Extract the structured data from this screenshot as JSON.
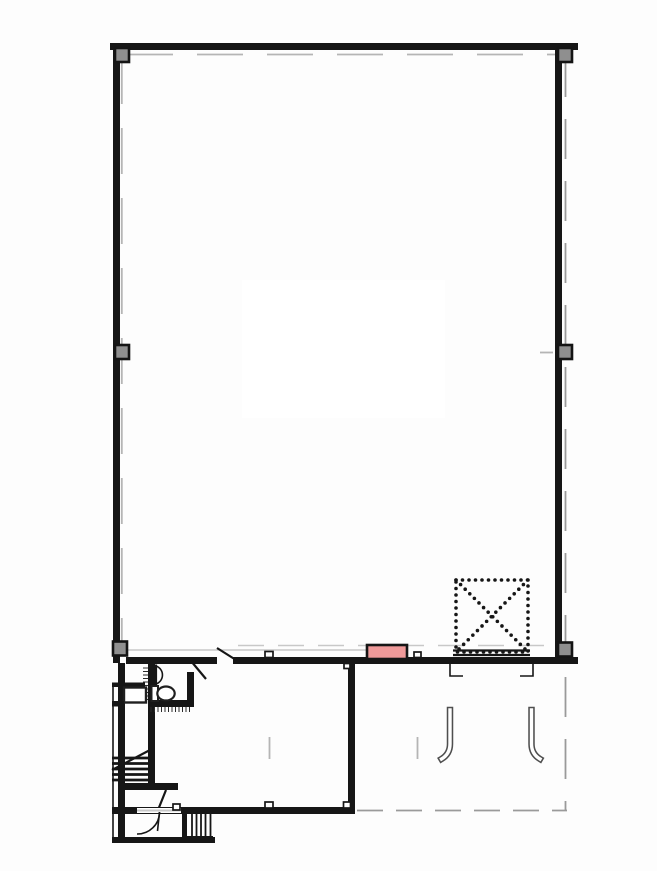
{
  "colors": {
    "wall": "#161616",
    "column_fill": "#8f8f8f",
    "column_border": "#141414",
    "accent_pink": "#f09a9a",
    "centerline": "#b5b5b5",
    "light_line": "#c8c8c8",
    "canopy_line": "#9a9a9a",
    "background": "#fdfdfd",
    "fixture_line": "#1f1f1f",
    "hook_line": "#4f4f4f"
  },
  "plan": {
    "features": [
      "main-hall-perimeter-walls",
      "column-markers",
      "dashed-roof-opening-with-x",
      "pink-door-marker",
      "restroom-with-toilet-and-sink",
      "interior-stair-with-break-line",
      "entrance-door-swing",
      "exterior-steps",
      "gate-swing-guides",
      "centerlines",
      "canopy-dashed-outline"
    ],
    "counts": {
      "column_markers": 6,
      "stair_treads": 5,
      "exterior_step_lines": 5
    }
  }
}
